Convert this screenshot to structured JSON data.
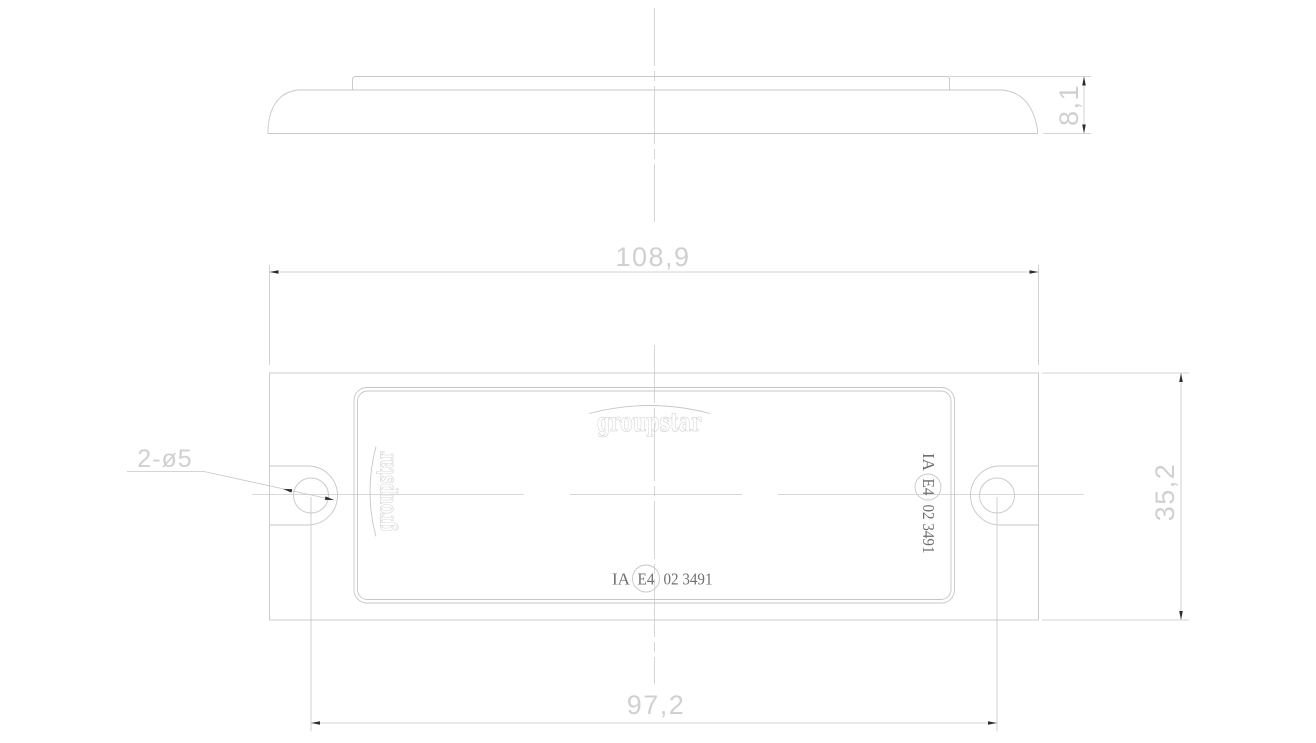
{
  "colors": {
    "bg": "#ffffff",
    "line": "#c7c7c7",
    "centerline": "#cccccc",
    "dimtext": "#d0d0d0",
    "logo": "#cdcdcd",
    "approval": "#6f6f6f",
    "arrow": "#2e2e2e"
  },
  "dimensions": {
    "profile_height": "8,1",
    "overall_width": "108,9",
    "hole_spacing": "97,2",
    "overall_height": "35,2",
    "hole_callout": "2-ø5"
  },
  "labels": {
    "brand": "groupstar",
    "approval": {
      "prefix": "IA",
      "circled": "E4",
      "suffix": "02 3491"
    }
  }
}
